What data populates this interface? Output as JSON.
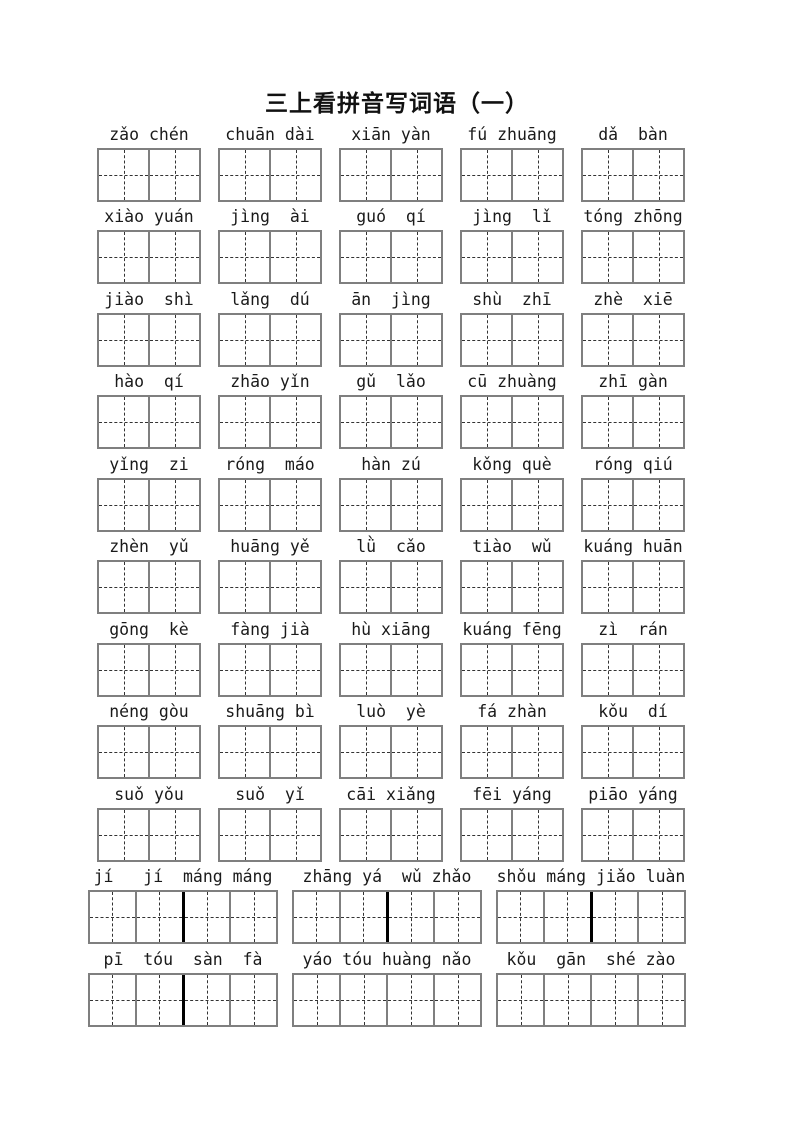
{
  "doc": {
    "title": "三上看拼音写词语（一）",
    "colors": {
      "page_bg": "#ffffff",
      "text": "#1a1a1a",
      "grid_border": "#7f7f7f",
      "grid_dash": "#333333",
      "grid_bold_divider": "#000000"
    }
  },
  "rows": [
    {
      "cells_per_word": 2,
      "words": [
        {
          "pinyin": "zǎo chén"
        },
        {
          "pinyin": "chuān dài"
        },
        {
          "pinyin": "xiān yàn"
        },
        {
          "pinyin": "fú zhuāng"
        },
        {
          "pinyin": "dǎ  bàn"
        }
      ]
    },
    {
      "cells_per_word": 2,
      "words": [
        {
          "pinyin": "xiào yuán"
        },
        {
          "pinyin": "jìng  ài"
        },
        {
          "pinyin": "guó  qí"
        },
        {
          "pinyin": "jìng  lǐ"
        },
        {
          "pinyin": "tóng zhōng"
        }
      ]
    },
    {
      "cells_per_word": 2,
      "words": [
        {
          "pinyin": "jiào  shì"
        },
        {
          "pinyin": "lǎng  dú"
        },
        {
          "pinyin": "ān  jìng"
        },
        {
          "pinyin": "shù  zhī"
        },
        {
          "pinyin": "zhè  xiē"
        }
      ]
    },
    {
      "cells_per_word": 2,
      "words": [
        {
          "pinyin": "hào  qí"
        },
        {
          "pinyin": "zhāo yǐn"
        },
        {
          "pinyin": "gǔ  lǎo"
        },
        {
          "pinyin": "cū zhuàng"
        },
        {
          "pinyin": "zhī gàn"
        }
      ]
    },
    {
      "cells_per_word": 2,
      "words": [
        {
          "pinyin": "yǐng  zi"
        },
        {
          "pinyin": "róng  máo"
        },
        {
          "pinyin": "hàn zú"
        },
        {
          "pinyin": "kǒng què"
        },
        {
          "pinyin": "róng qiú"
        }
      ]
    },
    {
      "cells_per_word": 2,
      "words": [
        {
          "pinyin": "zhèn  yǔ"
        },
        {
          "pinyin": "huāng yě"
        },
        {
          "pinyin": "lǜ  cǎo"
        },
        {
          "pinyin": "tiào  wǔ"
        },
        {
          "pinyin": "kuáng huān"
        }
      ]
    },
    {
      "cells_per_word": 2,
      "words": [
        {
          "pinyin": "gōng  kè"
        },
        {
          "pinyin": "fàng jià"
        },
        {
          "pinyin": "hù xiāng"
        },
        {
          "pinyin": "kuáng fēng"
        },
        {
          "pinyin": "zì  rán"
        }
      ]
    },
    {
      "cells_per_word": 2,
      "words": [
        {
          "pinyin": "néng gòu"
        },
        {
          "pinyin": "shuāng bì"
        },
        {
          "pinyin": "luò  yè"
        },
        {
          "pinyin": "fá zhàn"
        },
        {
          "pinyin": "kǒu  dí"
        }
      ]
    },
    {
      "cells_per_word": 2,
      "words": [
        {
          "pinyin": "suǒ yǒu"
        },
        {
          "pinyin": "suǒ  yǐ"
        },
        {
          "pinyin": "cāi xiǎng"
        },
        {
          "pinyin": "fēi yáng"
        },
        {
          "pinyin": "piāo yáng"
        }
      ]
    },
    {
      "cells_per_word": 4,
      "words": [
        {
          "pinyin": "jí   jí  máng máng",
          "bold_mid": true
        },
        {
          "pinyin": "zhāng yá  wǔ zhǎo",
          "bold_mid": true
        },
        {
          "pinyin": "shǒu máng jiǎo luàn",
          "bold_mid": true
        }
      ]
    },
    {
      "cells_per_word": 4,
      "words": [
        {
          "pinyin": "pī  tóu  sàn  fà",
          "bold_mid": true
        },
        {
          "pinyin": "yáo tóu huàng nǎo",
          "bold_mid": false
        },
        {
          "pinyin": "kǒu  gān  shé zào",
          "bold_mid": false
        }
      ]
    }
  ]
}
